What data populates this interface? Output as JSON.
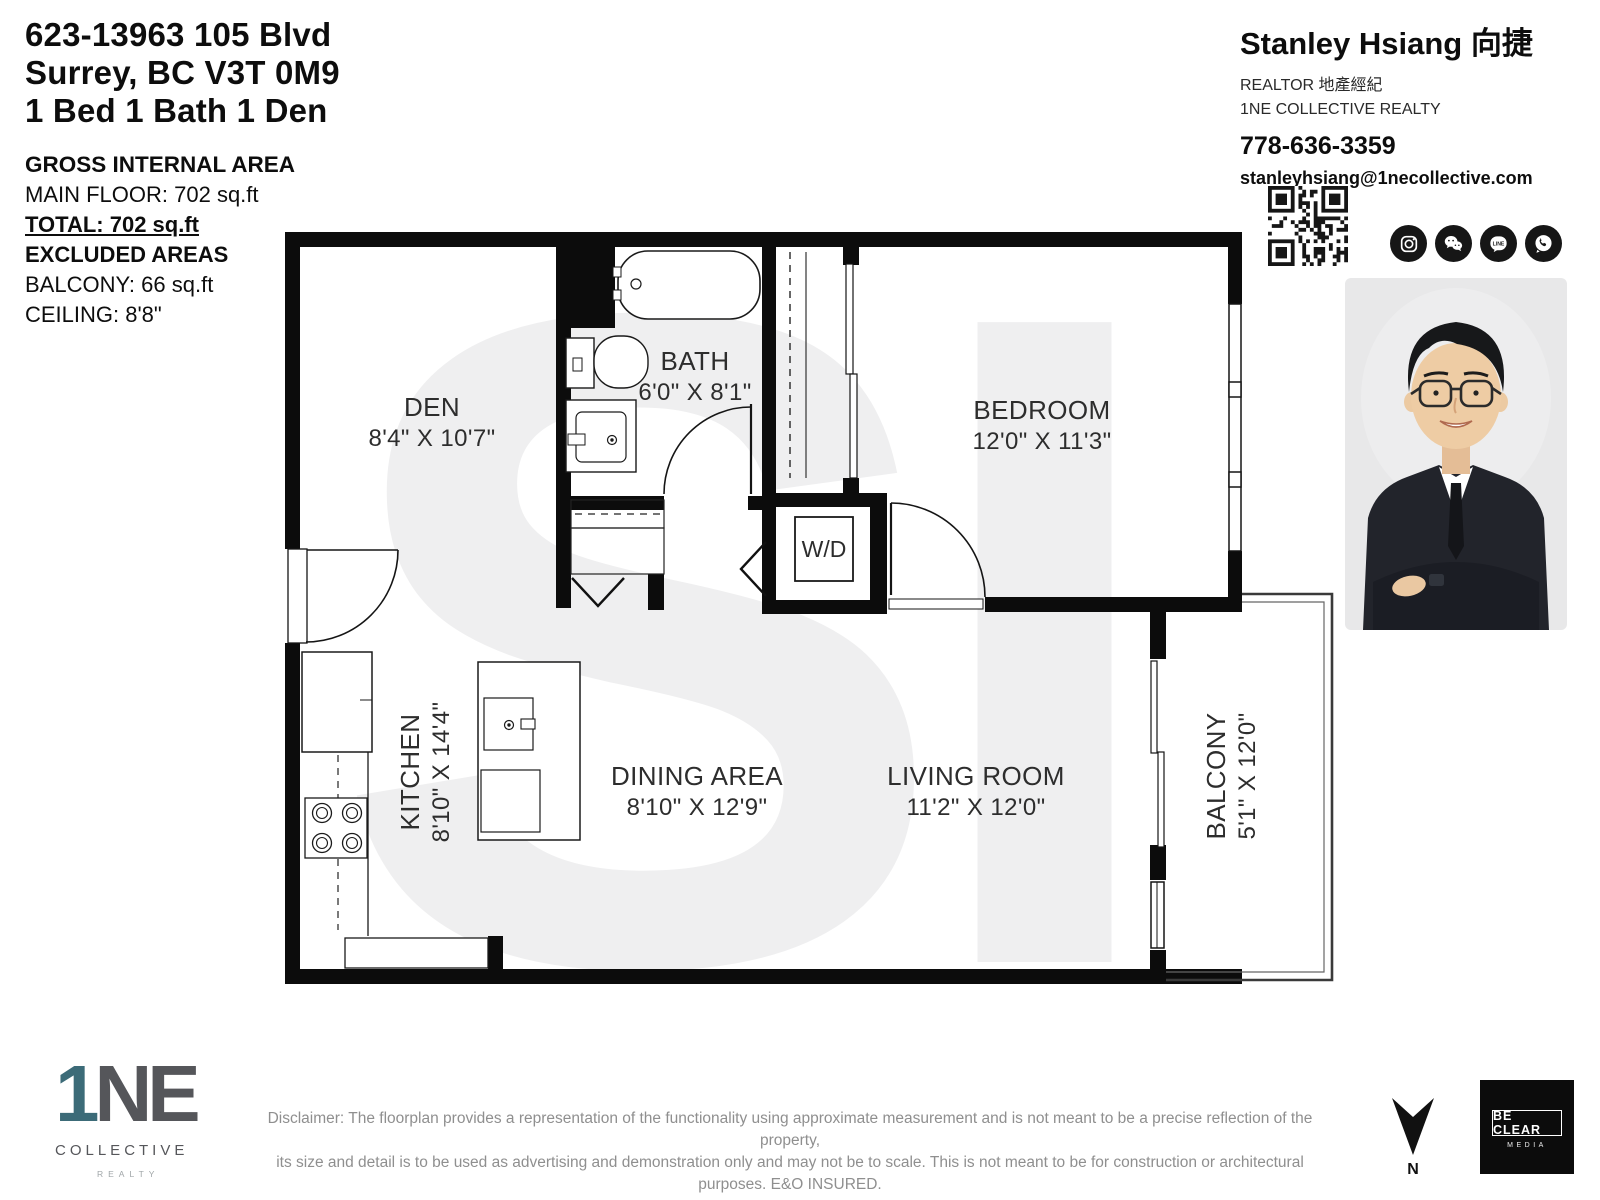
{
  "header": {
    "address_line1": "623-13963 105 Blvd",
    "address_line2": "Surrey, BC V3T 0M9",
    "address_line3": "1 Bed 1 Bath 1 Den",
    "gross_internal_area_label": "GROSS INTERNAL AREA",
    "main_floor": "MAIN FLOOR: 702 sq.ft",
    "total": "TOTAL: 702 sq.ft",
    "excluded_areas_label": "EXCLUDED AREAS",
    "balcony": "BALCONY: 66 sq.ft",
    "ceiling": "CEILING: 8'8\""
  },
  "agent": {
    "name": "Stanley Hsiang 向捷",
    "title": "REALTOR  地產經紀",
    "brokerage": "1NE COLLECTIVE REALTY",
    "phone": "778-636-3359",
    "email": "stanleyhsiang@1necollective.com",
    "line_icon_text": "LINE",
    "icons": [
      "instagram-icon",
      "wechat-icon",
      "line-icon",
      "whatsapp-icon"
    ]
  },
  "plan": {
    "rooms": [
      {
        "name": "DEN",
        "dims": "8'4\" X 10'7\""
      },
      {
        "name": "BATH",
        "dims": "6'0\" X 8'1\""
      },
      {
        "name": "BEDROOM",
        "dims": "12'0\" X 11'3\""
      },
      {
        "name": "KITCHEN",
        "dims": "8'10\" X 14'4\""
      },
      {
        "name": "DINING AREA",
        "dims": "8'10\" X 12'9\""
      },
      {
        "name": "LIVING ROOM",
        "dims": "11'2\" X 12'0\""
      },
      {
        "name": "BALCONY",
        "dims": "5'1\" X 12'0\""
      }
    ],
    "washer_dryer_label": "W/D",
    "watermark": "SI",
    "north_label": "N"
  },
  "footer": {
    "logo_one": "1",
    "logo_ne": "NE",
    "logo_collective": "COLLECTIVE",
    "logo_realty": "REALTY",
    "disclaimer_line1": "Disclaimer: The floorplan provides a representation of the functionality using approximate measurement and is not meant to be a precise reflection of the property,",
    "disclaimer_line2": "its size and detail is to be used as advertising and demonstration only and may not be to scale. This is not meant to be for construction or architectural purposes. E&O INSURED.",
    "media_badge_line1": "BE CLEAR",
    "media_badge_line2": "MEDIA"
  },
  "colors": {
    "wall": "#0c0c0c",
    "watermark": "#efeff0",
    "logo_accent_teal": "#3c6b78",
    "logo_gray": "#55565a",
    "disclaimer_gray": "#8f8f8f",
    "icon_background": "#161616"
  }
}
